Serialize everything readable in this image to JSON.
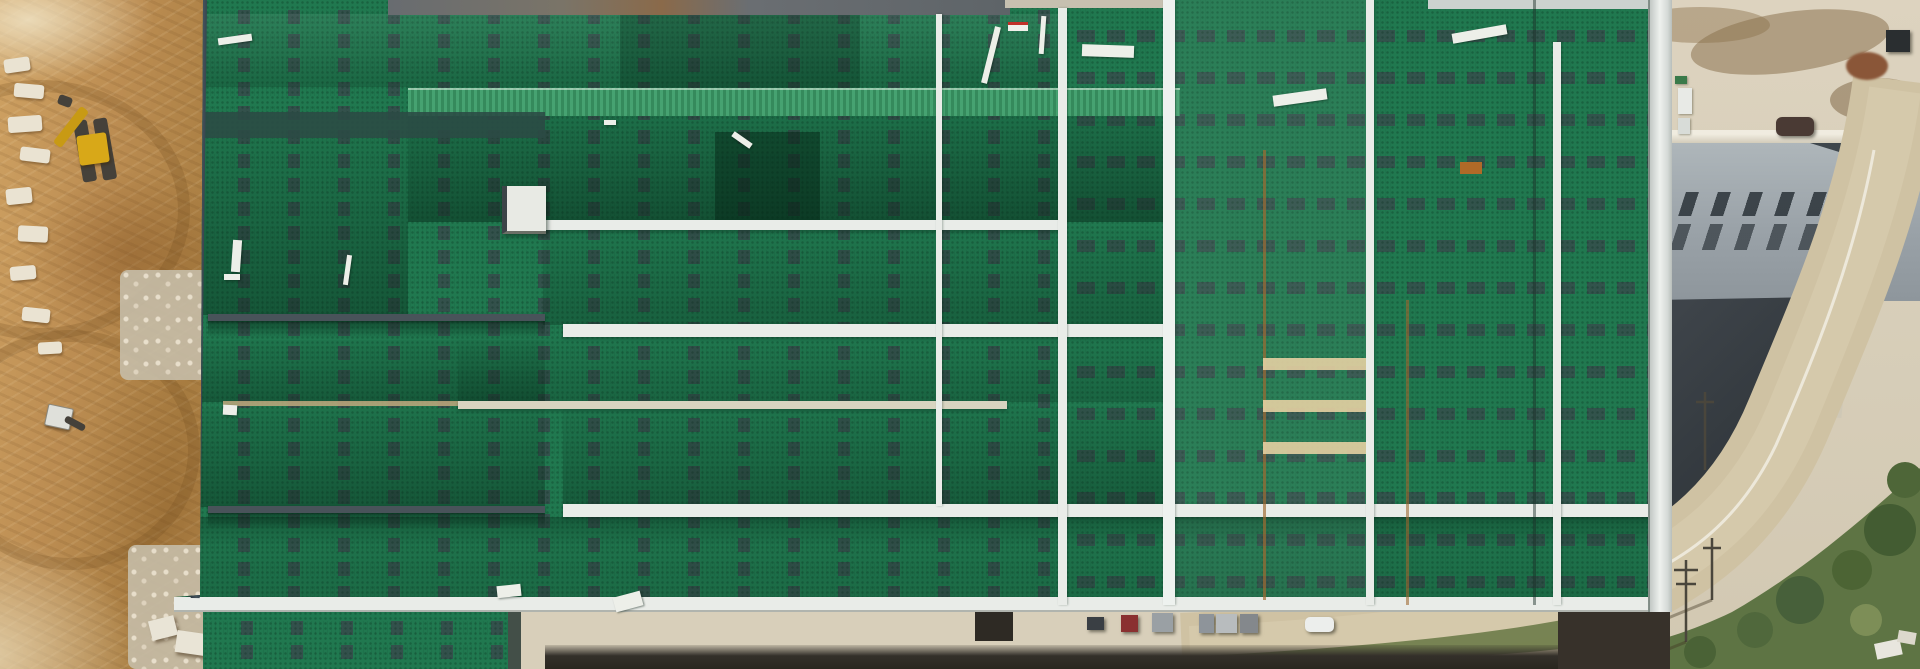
{
  "scene": {
    "title": "Aerial drone photograph of a large industrial warehouse under construction",
    "regions": {
      "left": "excavated brown earth with construction machinery and rock piles",
      "center": "green standing-seam warehouse roof with dashed skylight strips, white ridge caps and walkways",
      "right": "concrete yard, gray vented factory building with dark curved roof, curving access road with vegetation",
      "bottom": "service road with parked trucks and a white car beside a drainage ditch"
    }
  },
  "palette": {
    "green": "#20784f",
    "green_bright": "#3f9e6b",
    "white_line": "#e9ece8",
    "dark_fascia": "#3a464f",
    "dirt": "#bc8d52",
    "concrete": "#d8cfba",
    "roof_gray": "#9aa2a8",
    "charcoal": "#343a40",
    "road_tan": "#cfc2a3",
    "vegetation": "#5e7444",
    "rust": "#a06a30",
    "excavator_yellow": "#d8a818"
  },
  "objects": {
    "rocks": [
      {
        "x": 4,
        "y": 58,
        "w": 26,
        "h": 14,
        "r": -8
      },
      {
        "x": 14,
        "y": 84,
        "w": 30,
        "h": 14,
        "r": 5
      },
      {
        "x": 8,
        "y": 116,
        "w": 34,
        "h": 16,
        "r": -4
      },
      {
        "x": 20,
        "y": 148,
        "w": 30,
        "h": 14,
        "r": 7
      },
      {
        "x": 6,
        "y": 188,
        "w": 26,
        "h": 16,
        "r": -6
      },
      {
        "x": 18,
        "y": 226,
        "w": 30,
        "h": 16,
        "r": 3
      },
      {
        "x": 10,
        "y": 266,
        "w": 26,
        "h": 14,
        "r": -5
      },
      {
        "x": 22,
        "y": 308,
        "w": 28,
        "h": 14,
        "r": 6
      },
      {
        "x": 38,
        "y": 342,
        "w": 24,
        "h": 12,
        "r": -3
      }
    ],
    "debris": [
      {
        "x": 218,
        "y": 36,
        "w": 34,
        "h": 7,
        "r": -8
      },
      {
        "x": 232,
        "y": 240,
        "w": 9,
        "h": 32,
        "r": 4
      },
      {
        "x": 224,
        "y": 274,
        "w": 16,
        "h": 6,
        "r": 0
      },
      {
        "x": 223,
        "y": 405,
        "w": 14,
        "h": 10,
        "r": 3
      },
      {
        "x": 497,
        "y": 585,
        "w": 24,
        "h": 12,
        "r": -6
      },
      {
        "x": 614,
        "y": 594,
        "w": 28,
        "h": 15,
        "r": -15
      },
      {
        "x": 731,
        "y": 137,
        "w": 22,
        "h": 6,
        "r": 35
      },
      {
        "x": 988,
        "y": 26,
        "w": 6,
        "h": 58,
        "r": 14
      },
      {
        "x": 1040,
        "y": 16,
        "w": 5,
        "h": 38,
        "r": 4
      },
      {
        "x": 1082,
        "y": 45,
        "w": 52,
        "h": 12,
        "r": 2
      },
      {
        "x": 1273,
        "y": 92,
        "w": 54,
        "h": 11,
        "r": -8
      },
      {
        "x": 1452,
        "y": 29,
        "w": 55,
        "h": 10,
        "r": -10
      },
      {
        "x": 604,
        "y": 120,
        "w": 12,
        "h": 5,
        "r": 0
      },
      {
        "x": 345,
        "y": 255,
        "w": 5,
        "h": 30,
        "r": 8
      }
    ],
    "vehicles": [
      {
        "type": "dark-van",
        "x": 1087,
        "y": 617,
        "w": 17,
        "h": 13,
        "color": "#3a3f44",
        "shape": "box"
      },
      {
        "type": "red-truck",
        "x": 1121,
        "y": 615,
        "w": 17,
        "h": 17,
        "color": "#8a3030",
        "shape": "box"
      },
      {
        "type": "gray-truck",
        "x": 1152,
        "y": 613,
        "w": 21,
        "h": 19,
        "color": "#9aa0a4",
        "shape": "box"
      },
      {
        "type": "gray-truck",
        "x": 1199,
        "y": 614,
        "w": 15,
        "h": 19,
        "color": "#8e949a",
        "shape": "box"
      },
      {
        "type": "light-truck",
        "x": 1216,
        "y": 614,
        "w": 21,
        "h": 19,
        "color": "#b8bcbe",
        "shape": "box"
      },
      {
        "type": "gray-truck",
        "x": 1240,
        "y": 614,
        "w": 18,
        "h": 19,
        "color": "#84888c",
        "shape": "box"
      },
      {
        "type": "white-car",
        "x": 1305,
        "y": 617,
        "w": 29,
        "h": 15,
        "color": "#eceeec",
        "shape": "car"
      },
      {
        "type": "dark-suv",
        "x": 1776,
        "y": 117,
        "w": 38,
        "h": 19,
        "color": "#4a3a34",
        "shape": "suv"
      },
      {
        "type": "dark-bin",
        "x": 1886,
        "y": 30,
        "w": 24,
        "h": 22,
        "color": "#2a2e30",
        "shape": "box"
      },
      {
        "type": "debris-pile",
        "x": 1846,
        "y": 52,
        "w": 42,
        "h": 28,
        "color": "#8a5638",
        "shape": "pile"
      }
    ],
    "utility_boxes": [
      {
        "x": 1675,
        "y": 76,
        "w": 12,
        "h": 8,
        "color": "#3a7a4a"
      },
      {
        "x": 1678,
        "y": 88,
        "w": 14,
        "h": 26,
        "color": "#e8eae6"
      },
      {
        "x": 1678,
        "y": 118,
        "w": 12,
        "h": 16,
        "color": "#d8dcd8"
      }
    ]
  }
}
